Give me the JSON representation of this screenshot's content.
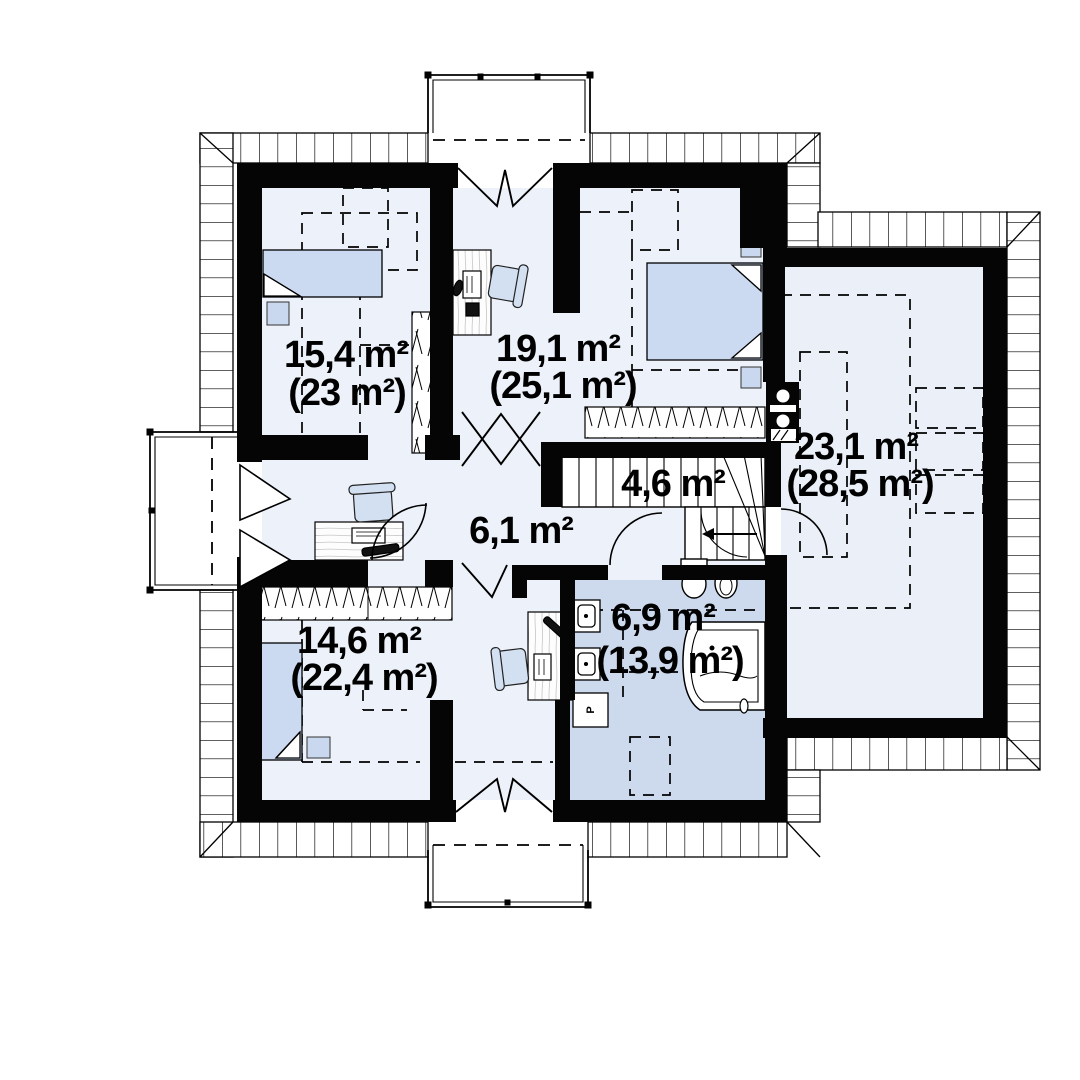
{
  "plan": {
    "type": "floor-plan-attic-storey"
  },
  "rooms": [
    {
      "name": "bedroom-top-left",
      "area": "15,4 m²",
      "area_total": "(23 m²)"
    },
    {
      "name": "bedroom-top-middle",
      "area": "19,1 m²",
      "area_total": "(25,1 m²)"
    },
    {
      "name": "room-right",
      "area": "23,1 m²",
      "area_total": "(28,5 m²)"
    },
    {
      "name": "staircase",
      "area": "4,6 m²"
    },
    {
      "name": "hall",
      "area": "6,1 m²"
    },
    {
      "name": "bedroom-bottom-left",
      "area": "14,6 m²",
      "area_total": "(22,4 m²)"
    },
    {
      "name": "bathroom",
      "area": "6,9 m²",
      "area_total": "(13,9 m²)"
    }
  ],
  "labels": {
    "washing_machine": "P"
  },
  "colors": {
    "wall": "#050505",
    "floor": "#edf1f9",
    "bathroom_floor": "#cddaee",
    "furniture_blue": "#cbdaf0",
    "line": "#000000"
  }
}
